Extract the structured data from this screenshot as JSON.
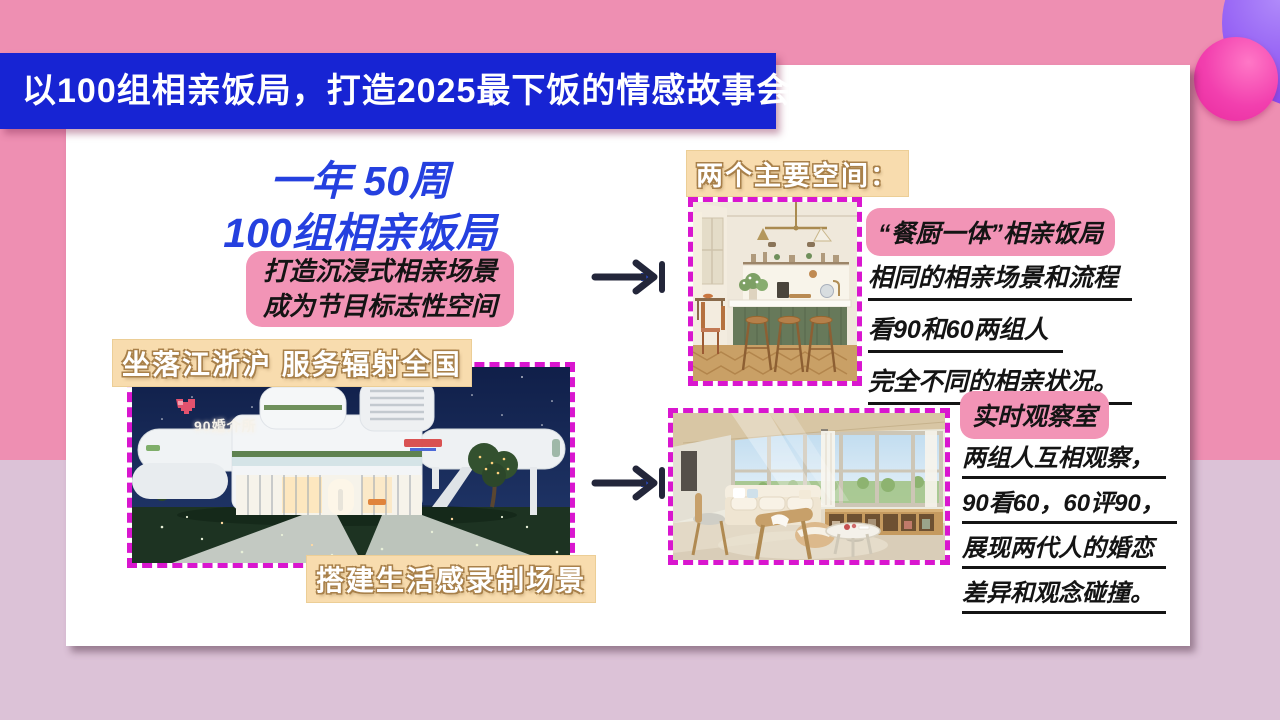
{
  "slide": {
    "header": {
      "title": "以100组相亲饭局，打造2025最下饭的情感故事会"
    },
    "left": {
      "headline_line1": "一年 50周",
      "headline_line2": "100组相亲饭局",
      "note_line1": "打造沉浸式相亲场景",
      "note_line2": "成为节目标志性空间",
      "location_label": "坐落江浙沪 服务辐射全国",
      "build_label": "搭建生活感录制场景",
      "building_sign": "90婚介所"
    },
    "right": {
      "section_label": "两个主要空间：",
      "space1": {
        "title": "“餐厨一体”相亲饭局",
        "lines": [
          "相同的相亲场景和流程",
          "看90和60两组人",
          "完全不同的相亲状况。"
        ]
      },
      "space2": {
        "title": "实时观察室",
        "lines": [
          "两组人互相观察，",
          "90看60，60评90，",
          "展现两代人的婚恋",
          "差异和观念碰撞。"
        ]
      }
    },
    "colors": {
      "background_top": "#ee8fb2",
      "background_bottom": "#dcc2d7",
      "banner_blue": "#1724d3",
      "headline_blue": "#2540df",
      "pink_highlight": "#f294b6",
      "tan_highlight": "#f8dcae",
      "dash_magenta": "#d916cf",
      "arrow_dark": "#23263a",
      "circle_purple": "#8a4ff2",
      "circle_pink": "#f23fae"
    }
  }
}
